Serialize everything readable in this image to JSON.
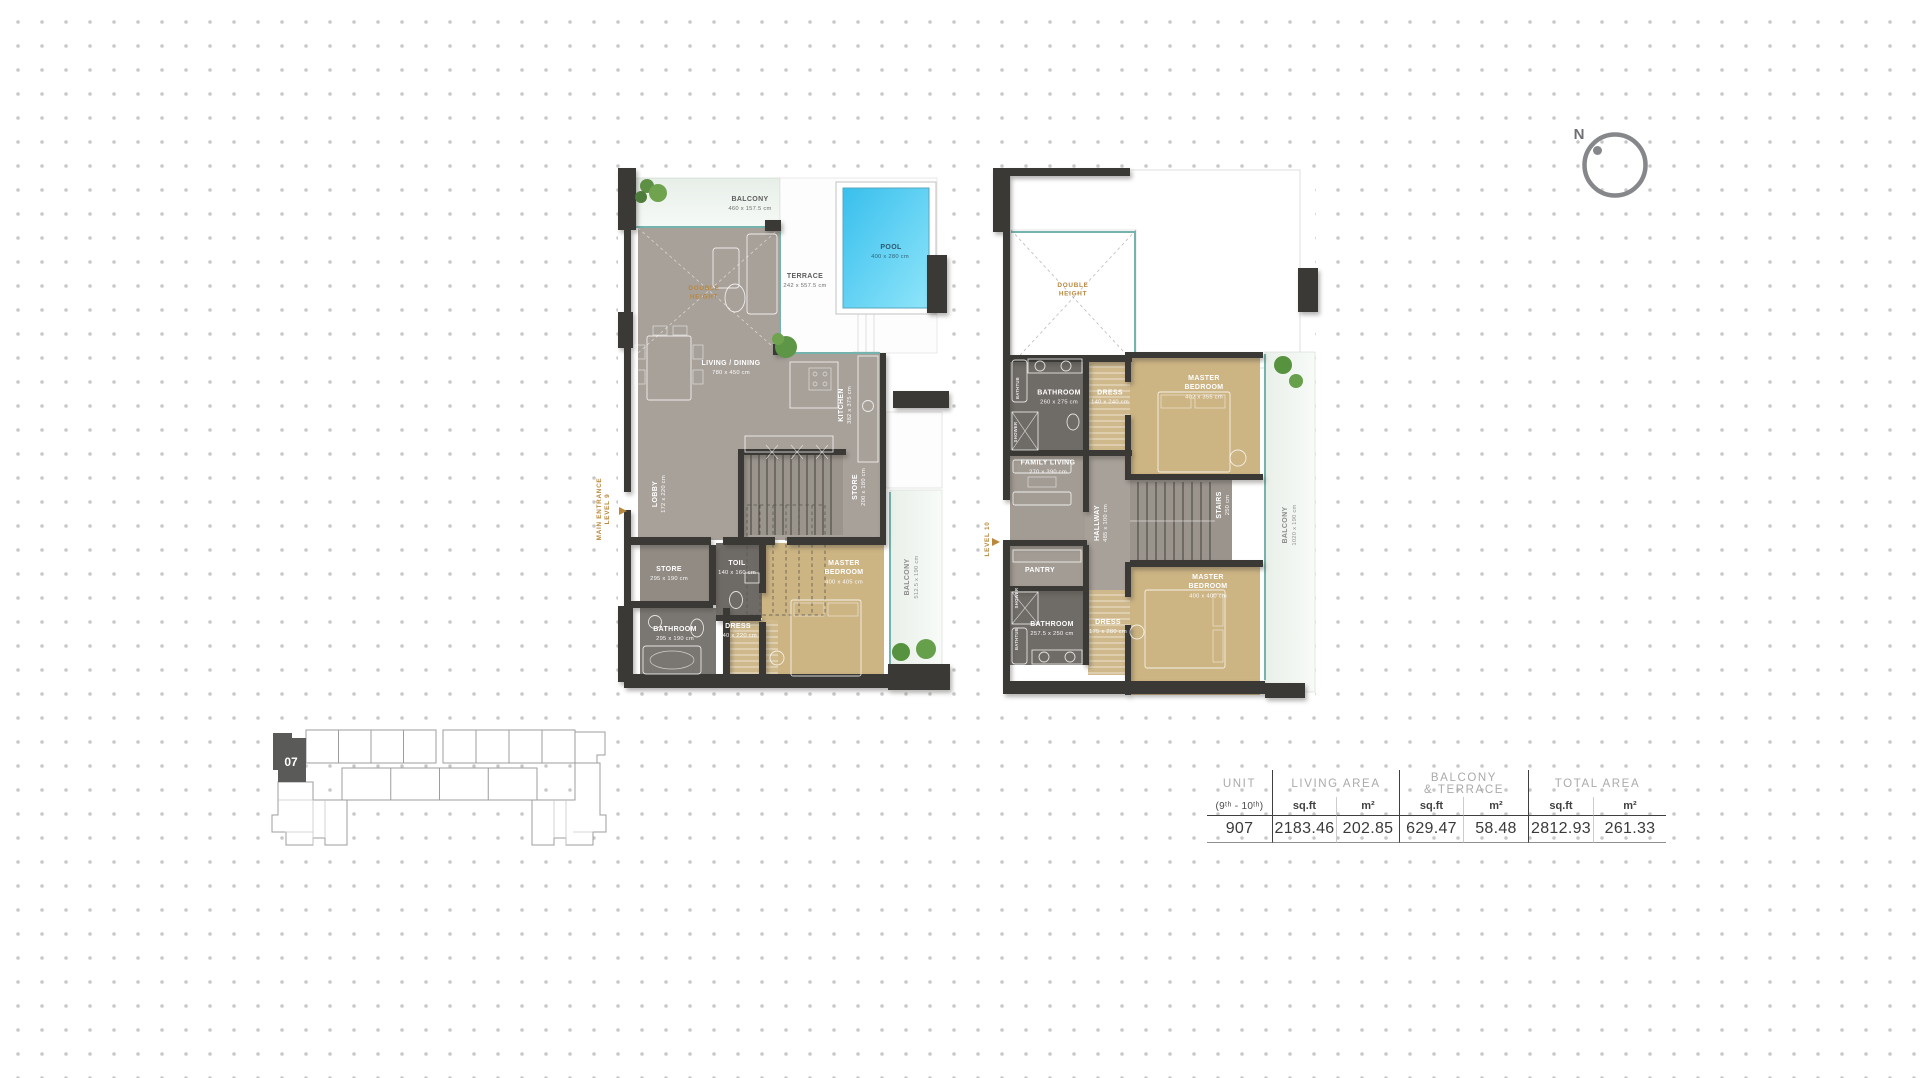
{
  "compass": {
    "label": "N"
  },
  "keyplan": {
    "unit": "07"
  },
  "plan9": {
    "entrance_line1": "MAIN ENTRANCE",
    "entrance_line2": "LEVEL 9",
    "balcony_top": {
      "n": "BALCONY",
      "d": "460 x 157.5 cm"
    },
    "pool": {
      "n": "POOL",
      "d": "400 x 280 cm"
    },
    "terrace": {
      "n": "TERRACE",
      "d": "242 x 557.5 cm"
    },
    "double_height_1": "DOUBLE",
    "double_height_2": "HEIGHT",
    "living": {
      "n": "LIVING / DINING",
      "d": "780 x 450 cm"
    },
    "kitchen": {
      "n": "KITCHEN",
      "d": "382 x 375 cm"
    },
    "lobby": {
      "n": "LOBBY",
      "d": "172 x 220 cm"
    },
    "store_upper": {
      "n": "STORE",
      "d": "200 x 180 cm"
    },
    "store": {
      "n": "STORE",
      "d": "295 x 190 cm"
    },
    "toilet": {
      "n": "TOIL",
      "d": "140 x 160 cm"
    },
    "master_1": "MASTER",
    "master_2": "BEDROOM",
    "master_d": "400 x 405 cm",
    "bathroom": {
      "n": "BATHROOM",
      "d": "295 x 190 cm"
    },
    "dress": {
      "n": "DRESS",
      "d": "140 x 220 cm"
    },
    "balcony_side": {
      "n": "BALCONY",
      "d": "512.5 x 190 cm"
    }
  },
  "plan10": {
    "level_label": "LEVEL 10",
    "double_height_1": "DOUBLE",
    "double_height_2": "HEIGHT",
    "bathroom_top": {
      "n": "BATHROOM",
      "d": "260 x 275 cm"
    },
    "bathtub": "BATHTUB",
    "shower": "SHOWER",
    "dress_top": {
      "n": "DRESS",
      "d": "140 x 240 cm"
    },
    "master_top_1": "MASTER",
    "master_top_2": "BEDROOM",
    "master_top_d": "402 x 355 cm",
    "family": {
      "n": "FAMILY LIVING",
      "d": "270 x 390 cm"
    },
    "hallway": {
      "n": "HALLWAY",
      "d": "485 x 100 cm"
    },
    "stairs": {
      "n": "STAIRS",
      "d": "250 cm"
    },
    "balcony_side": {
      "n": "BALCONY",
      "d": "1020 x 190 cm"
    },
    "pantry": "PANTRY",
    "bathroom_bottom": {
      "n": "BATHROOM",
      "d": "257.5 x 250 cm"
    },
    "dress_bottom": {
      "n": "DRESS",
      "d": "175 x 280 cm"
    },
    "master_bottom_1": "MASTER",
    "master_bottom_2": "BEDROOM",
    "master_bottom_d": "400 x 400 cm"
  },
  "table": {
    "unit_title": "UNIT",
    "unit_sub": "(9ᵗʰ - 10ᵗʰ)",
    "living_title": "LIVING AREA",
    "balcony_title_1": "BALCONY",
    "balcony_title_2": "& TERRACE",
    "total_title": "TOTAL AREA",
    "sqft": "sq.ft",
    "m2": "m²",
    "values": {
      "unit": "907",
      "living_sqft": "2183.46",
      "living_m2": "202.85",
      "balcony_sqft": "629.47",
      "balcony_m2": "58.48",
      "total_sqft": "2812.93",
      "total_m2": "261.33"
    }
  },
  "colors": {
    "accent_gold": "#b9883e",
    "pool_blue": "#41c3ee",
    "wall": "#3b3936",
    "window_teal": "#74b3ae",
    "floor_gray": "#a8a19a",
    "bedroom_tan": "#ccb483"
  }
}
